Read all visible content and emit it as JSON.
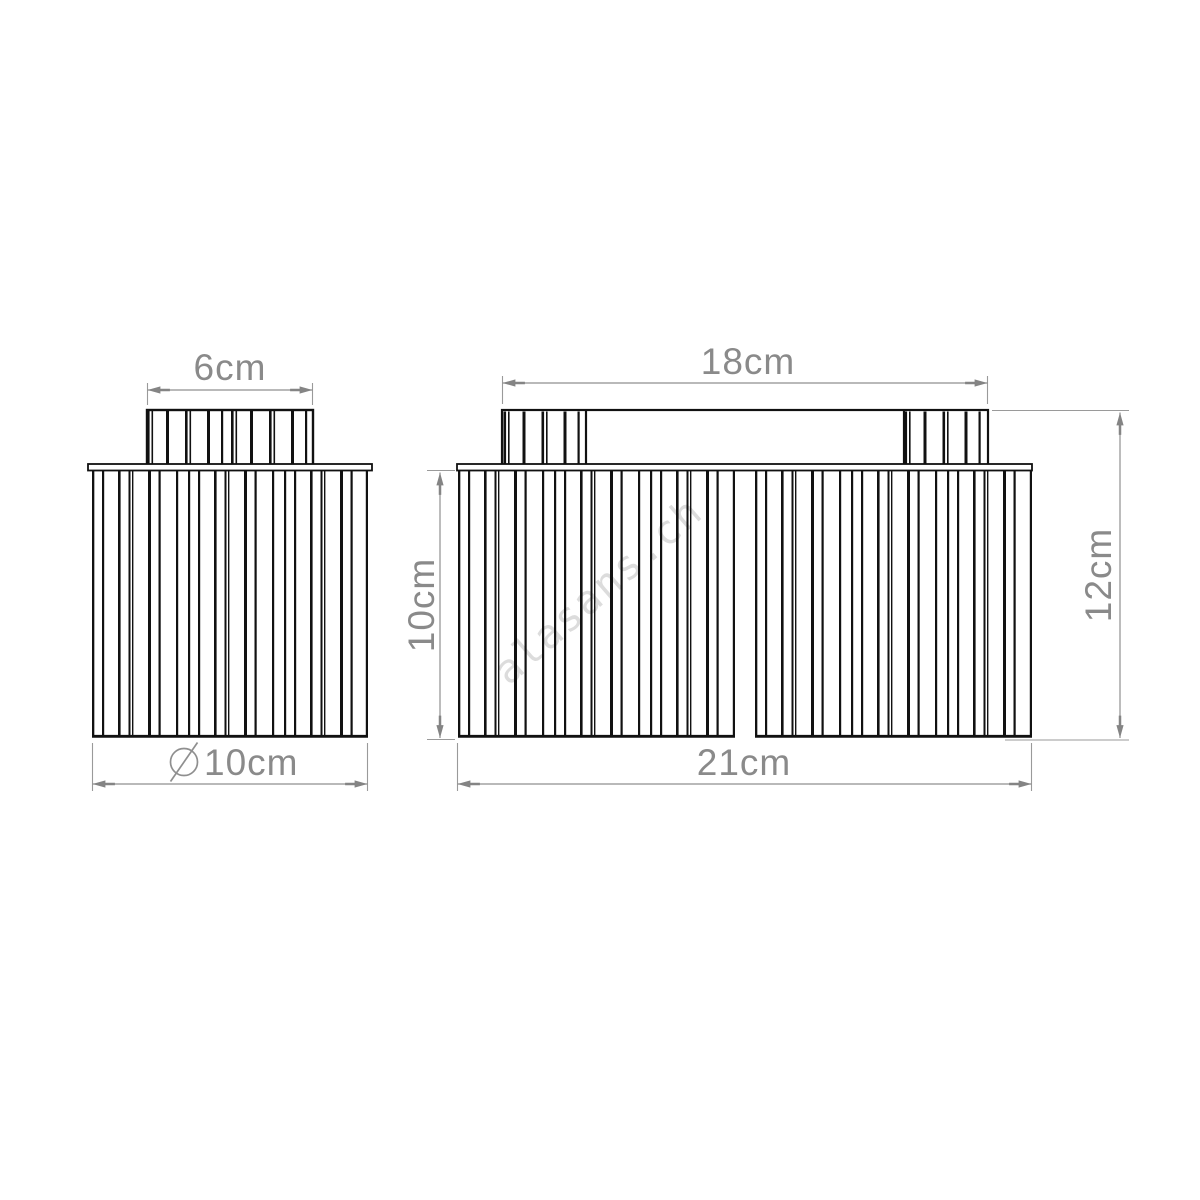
{
  "watermark": {
    "text": "alasans.ch"
  },
  "single_shade_view": {
    "cap_width_label": "6cm",
    "diameter_symbol": "⌀",
    "diameter_label": "10cm"
  },
  "double_shade_view": {
    "bar_width_label": "18cm",
    "shade_height_label": "10cm",
    "total_height_label": "12cm",
    "total_width_label": "21cm"
  },
  "colors": {
    "background": "#ffffff",
    "drawing_lines": "#111111",
    "dimension_lines": "#8f8f8f",
    "dimension_text": "#8a8a8a",
    "watermark": "#dcdcdc"
  }
}
